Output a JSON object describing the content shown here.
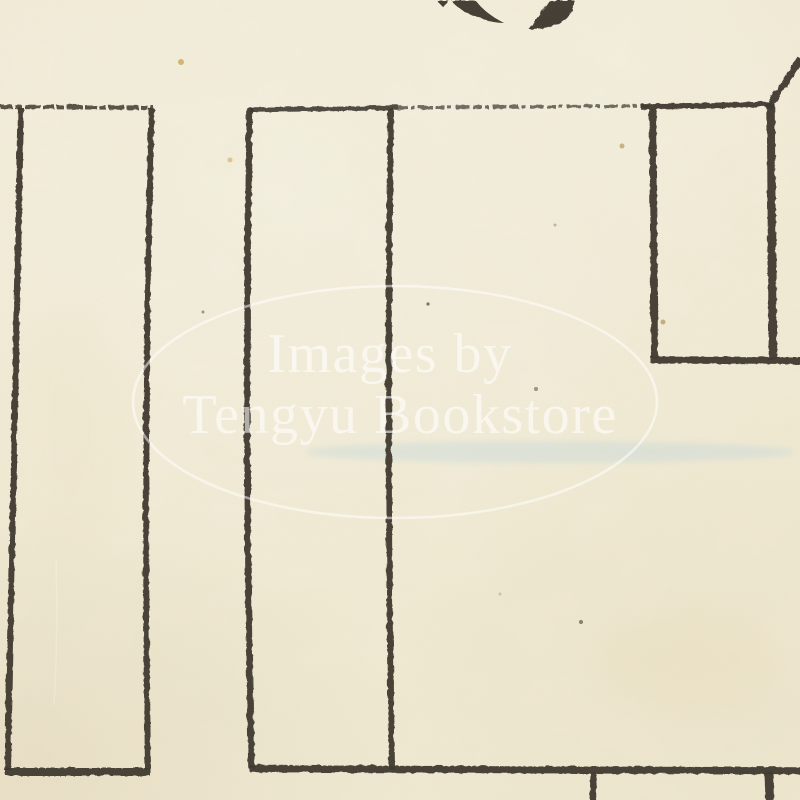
{
  "scene": {
    "description": "Scanned fragment of an antique Japanese block map on cream paper",
    "paper_color": "#f2ecd6",
    "ink_color": "#3e3a30",
    "ink_color_light": "#4a453a"
  },
  "watermark": {
    "line1": "Images by",
    "line2": "Tengyu Bookstore",
    "color": "#ffffff",
    "opacity": 0.58,
    "ellipse": {
      "cx": 395,
      "cy": 402,
      "rx": 262,
      "ry": 116
    }
  },
  "kanji_fragment": {
    "note": "partial character clipped by top edge of scan",
    "paths": [
      "M436,0 L448,0 L442,6 Z",
      "M451,0 L475,0 C481,8 491,16 503,22 C488,22 470,15 459,8 C454,4 452,2 451,0 Z",
      "M548,0 L574,0 C573,10 567,19 556,24 C547,27.5 537,28.5 528,28.5 C534,21 540,13 544,6 Z"
    ]
  },
  "map_lines": [
    {
      "name": "top-edge-left-plot",
      "d": "M0,106 L153,107",
      "w": 4,
      "dash": "12 2 7 3 16 2",
      "op": 0.85
    },
    {
      "name": "top-edge-middle-solid",
      "d": "M249,109 L398,107",
      "w": 4.5,
      "op": 0.9
    },
    {
      "name": "top-edge-middle-faint",
      "d": "M398,107 L648,105",
      "w": 3.5,
      "dash": "9 3 4 4 14 3",
      "op": 0.72
    },
    {
      "name": "top-edge-right-dark",
      "d": "M640,106 L771,104",
      "w": 5.5,
      "op": 0.95
    },
    {
      "name": "left-boundary",
      "d": "M20,107 L7,770",
      "w": 6,
      "op": 0.95
    },
    {
      "name": "left-plot-right-edge",
      "d": "M151,108 Q142,430 147,769",
      "w": 6,
      "op": 0.95
    },
    {
      "name": "middle-plot-left-edge",
      "d": "M249,107 Q243,430 251,768",
      "w": 6.5,
      "op": 0.95
    },
    {
      "name": "middle-plot-divider",
      "d": "M390,108 Q386,430 391,769",
      "w": 6,
      "op": 0.95
    },
    {
      "name": "notch-left-edge",
      "d": "M652,108 L654,357",
      "w": 7,
      "op": 0.95
    },
    {
      "name": "notch-right-edge",
      "d": "M770,104 L772,359",
      "w": 8.5,
      "op": 0.95
    },
    {
      "name": "notch-bottom-edge",
      "d": "M650,359 L800,360",
      "w": 7,
      "op": 0.95
    },
    {
      "name": "diagonal-boundary",
      "d": "M768,107 L800,58",
      "w": 7,
      "op": 0.95
    },
    {
      "name": "bottom-edge-left-plot",
      "d": "M5,771 L150,771",
      "w": 8,
      "op": 0.95
    },
    {
      "name": "bottom-edge-right",
      "d": "M249,768 L800,770",
      "w": 7.5,
      "op": 0.95
    },
    {
      "name": "lower-stub-left",
      "d": "M593,772 L592,800",
      "w": 6,
      "op": 0.95
    },
    {
      "name": "lower-stub-right",
      "d": "M768,772 L769,800",
      "w": 9,
      "op": 0.95
    }
  ],
  "stains": [
    {
      "name": "blue-smudge-band",
      "cx": 550,
      "cy": 452,
      "rx": 245,
      "ry": 11,
      "color": "#b9d2dc",
      "opacity": 0.32,
      "blur": 3
    },
    {
      "name": "warm-patch-bottom-right",
      "cx": 690,
      "cy": 660,
      "rx": 90,
      "ry": 55,
      "color": "#e8dcb8",
      "opacity": 0.25,
      "blur": 14
    },
    {
      "name": "warm-patch-left",
      "cx": 70,
      "cy": 430,
      "rx": 60,
      "ry": 120,
      "color": "#ecdfc0",
      "opacity": 0.2,
      "blur": 16
    }
  ],
  "specks": [
    {
      "name": "speck-yellow-fiber-1",
      "x": 181,
      "y": 62,
      "r": 3,
      "color": "#c9a352",
      "op": 0.75
    },
    {
      "name": "speck-yellow-fiber-2",
      "x": 230,
      "y": 160,
      "r": 2.5,
      "color": "#cfae58",
      "op": 0.6
    },
    {
      "name": "speck-dark-1",
      "x": 428,
      "y": 304,
      "r": 1.6,
      "color": "#6f6755",
      "op": 0.9
    },
    {
      "name": "speck-dark-2",
      "x": 203,
      "y": 312,
      "r": 1.5,
      "color": "#7a7260",
      "op": 0.7
    },
    {
      "name": "speck-dark-3",
      "x": 536,
      "y": 389,
      "r": 2,
      "color": "#837b68",
      "op": 0.8
    },
    {
      "name": "speck-dark-4",
      "x": 581,
      "y": 622,
      "r": 2,
      "color": "#6f6757",
      "op": 0.8
    },
    {
      "name": "speck-brown-1",
      "x": 663,
      "y": 322,
      "r": 2.5,
      "color": "#a98f54",
      "op": 0.65
    },
    {
      "name": "speck-brown-2",
      "x": 622,
      "y": 146,
      "r": 2.5,
      "color": "#b1945a",
      "op": 0.65
    },
    {
      "name": "speck-faint-1",
      "x": 555,
      "y": 225,
      "r": 1.5,
      "color": "#978f7c",
      "op": 0.6
    },
    {
      "name": "speck-faint-2",
      "x": 500,
      "y": 594,
      "r": 1.5,
      "color": "#a89f8a",
      "op": 0.5
    }
  ]
}
